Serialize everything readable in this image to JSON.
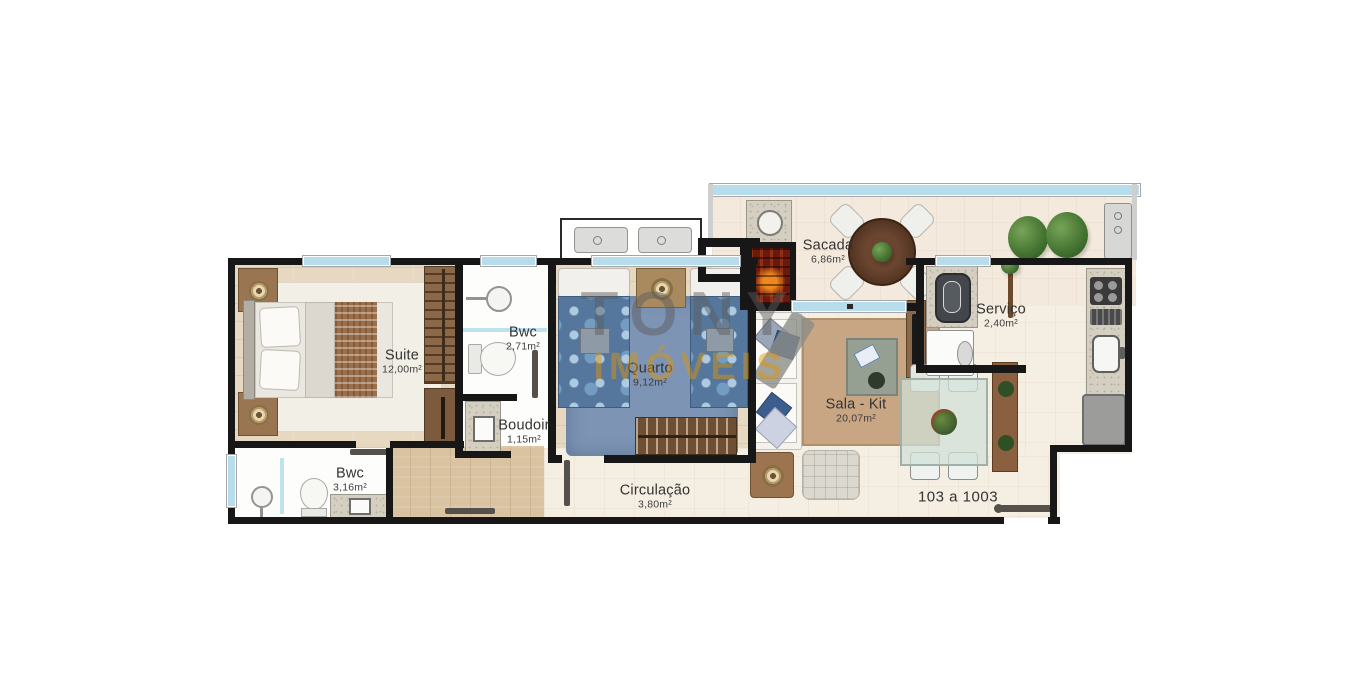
{
  "watermark": {
    "line1": "TONY",
    "line2": "IMÓVEIS"
  },
  "unit_label": "103 a 1003",
  "rooms": {
    "suite": {
      "name": "Suite",
      "area": "12,00m²"
    },
    "bwc_suite": {
      "name": "Bwc",
      "area": "2,71m²"
    },
    "boudoir": {
      "name": "Boudoir",
      "area": "1,15m²"
    },
    "quarto": {
      "name": "Quarto",
      "area": "9,12m²"
    },
    "sacada": {
      "name": "Sacada",
      "area": "6,86m²"
    },
    "servico": {
      "name": "Serviço",
      "area": "2,40m²"
    },
    "sala_kit": {
      "name": "Sala - Kit",
      "area": "20,07m²"
    },
    "bwc_social": {
      "name": "Bwc",
      "area": "3,16m²"
    },
    "circulacao": {
      "name": "Circulação",
      "area": "3,80m²"
    }
  },
  "palette": {
    "wall": "#171717",
    "window": "#b7dcec",
    "tile_floor": "#f5eee3",
    "wood_floor": "#e7d8c1",
    "hall_wood": "#d9c3a1",
    "quarto_rug": "#7d94b4",
    "quarto_bed": "#55779d",
    "sala_rug": "#c8a583",
    "grill_brick": "#6b190e",
    "plant_green": "#41702f",
    "watermark_gray": "#5c5c5c",
    "watermark_orange": "#e59400"
  }
}
